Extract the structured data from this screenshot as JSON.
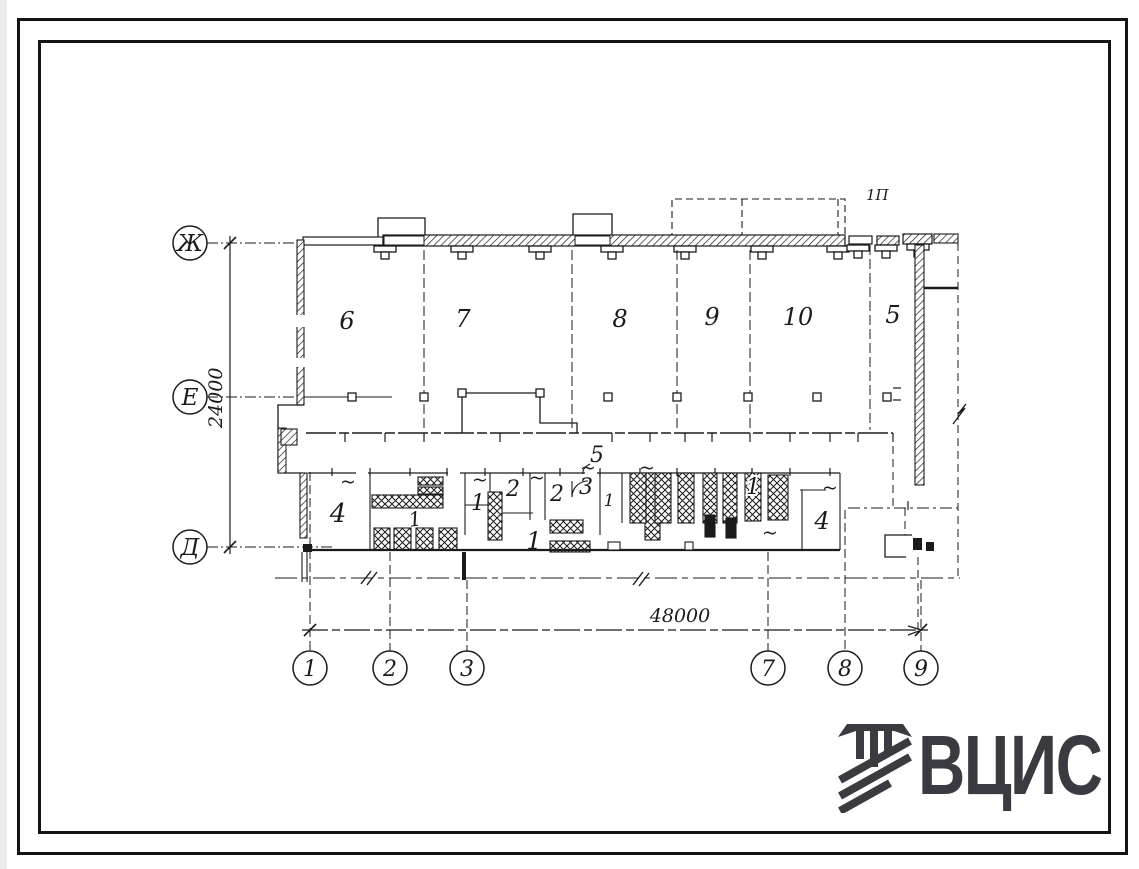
{
  "colors": {
    "ink": "#1b1b1b",
    "logo": "#3a3a41",
    "paper": "#ffffff"
  },
  "axes": {
    "rows": [
      {
        "label": "Ж"
      },
      {
        "label": "Е"
      },
      {
        "label": "Д"
      }
    ],
    "cols": [
      {
        "label": "1"
      },
      {
        "label": "2"
      },
      {
        "label": "3"
      },
      {
        "label": "7"
      },
      {
        "label": "8"
      },
      {
        "label": "9"
      }
    ]
  },
  "dimensions": {
    "height": "24000",
    "width": "48000"
  },
  "plan": {
    "upper_rooms": [
      {
        "label": "6"
      },
      {
        "label": "7"
      },
      {
        "label": "8"
      },
      {
        "label": "9"
      },
      {
        "label": "10"
      },
      {
        "label": "5"
      }
    ],
    "lower_rooms": [
      {
        "label": "4"
      },
      {
        "label": "1"
      },
      {
        "label": "1"
      },
      {
        "label": "2"
      },
      {
        "label": "2"
      },
      {
        "label": "3"
      },
      {
        "label": "1"
      },
      {
        "label": "1"
      },
      {
        "label": "1"
      },
      {
        "label": "4"
      }
    ],
    "callout_room": "5",
    "canopy_label": "1П",
    "tilde": "~"
  },
  "logo": {
    "text": "ВЦИС"
  }
}
